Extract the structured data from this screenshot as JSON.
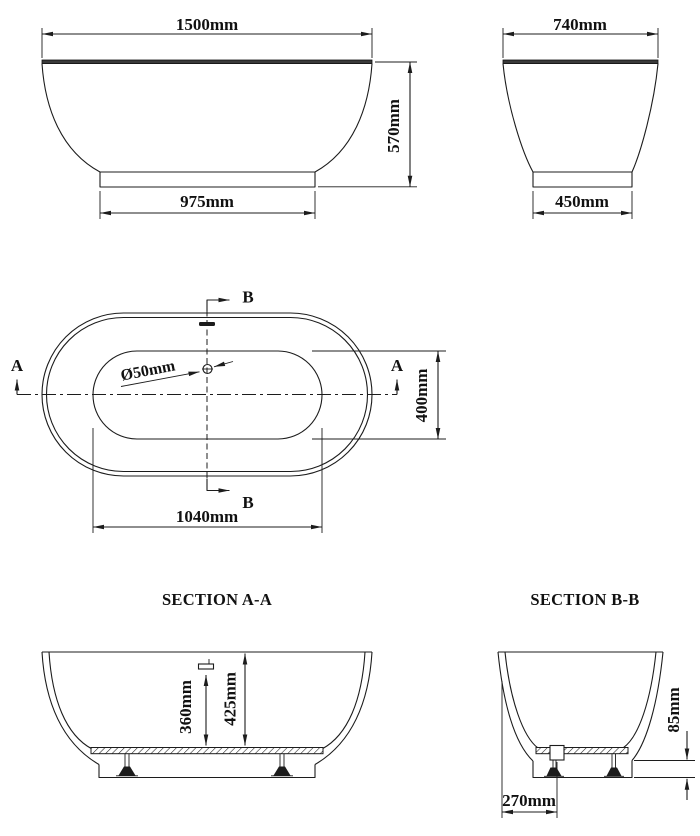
{
  "sheet": {
    "background": "#ffffff",
    "line_color": "#1c1c1c"
  },
  "front_view": {
    "width": "1500mm",
    "height": "570mm",
    "base_width": "975mm"
  },
  "side_view": {
    "width": "740mm",
    "base_width": "450mm"
  },
  "plan_view": {
    "drain_diameter": "Ø50mm",
    "basin_length": "1040mm",
    "basin_width": "400mm",
    "section_a": "A",
    "section_b": "B"
  },
  "section_aa": {
    "title": "SECTION A-A",
    "overflow_height": "360mm",
    "inner_depth": "425mm"
  },
  "section_bb": {
    "title": "SECTION B-B",
    "base_height": "85mm",
    "drain_offset": "270mm"
  }
}
